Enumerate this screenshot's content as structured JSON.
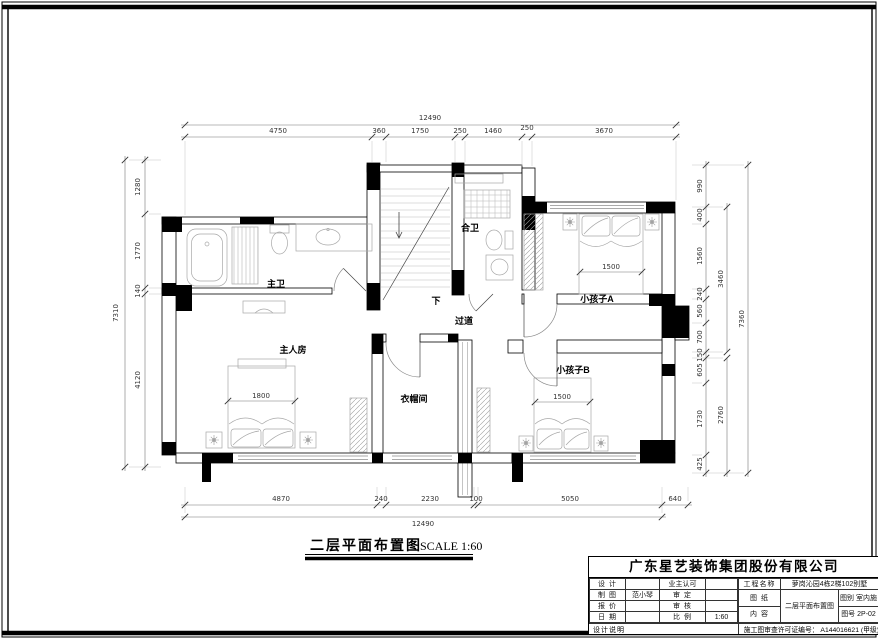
{
  "caption": {
    "title": "二层平面布置图",
    "scale": "SCALE 1:60"
  },
  "rooms": {
    "master_bath": "主卫",
    "shared_bath": "合卫",
    "kid_a": "小孩子A",
    "master_bedroom": "主人房",
    "closet": "衣帽间",
    "kid_b": "小孩子B",
    "corridor": "过道",
    "stairs_down": "下"
  },
  "dims": {
    "top": {
      "total": "12490",
      "segments": [
        "4750",
        "360",
        "1750",
        "250",
        "1460",
        "250",
        "3670"
      ]
    },
    "bottom": {
      "total": "12490",
      "segments": [
        "4870",
        "240",
        "2230",
        "100",
        "5050",
        "640"
      ]
    },
    "left": {
      "total": "7310",
      "segments": [
        "1280",
        "1770",
        "140",
        "4120"
      ]
    },
    "right": {
      "total": "7360",
      "spans": [
        "3460",
        "2760"
      ],
      "segments": [
        "990",
        "400",
        "1560",
        "240",
        "560",
        "700",
        "150",
        "605",
        "1730",
        "425"
      ]
    },
    "beds": {
      "master": "1800",
      "kid_a": "1500",
      "kid_b": "1500"
    }
  },
  "titleblock": {
    "company": "广东星艺装饰集团股份有限公司",
    "labels": {
      "design": "设 计",
      "owner_ok": "业主认可",
      "draft": "制 图",
      "verify": "审 定",
      "quote": "报 价",
      "review": "审 核",
      "date": "日 期",
      "ratio": "比 例",
      "project": "工程名称",
      "sheet": "图 纸",
      "content": "内 容",
      "category": "图别 室内施",
      "number": "图号 2P-02",
      "notes": "设计说明"
    },
    "values": {
      "draft_by": "范小琴",
      "ratio": "1:60",
      "project_name": "萝岗沁园4栋2梯102别墅",
      "content_name": "二层平面布置图",
      "permit": "施工图审查许可证编号： A144016621 (甲级)"
    }
  },
  "colors": {
    "wall": "#000000",
    "fixture": "#a8a8a8",
    "dim_line": "#777777",
    "dim_text": "#333333"
  }
}
